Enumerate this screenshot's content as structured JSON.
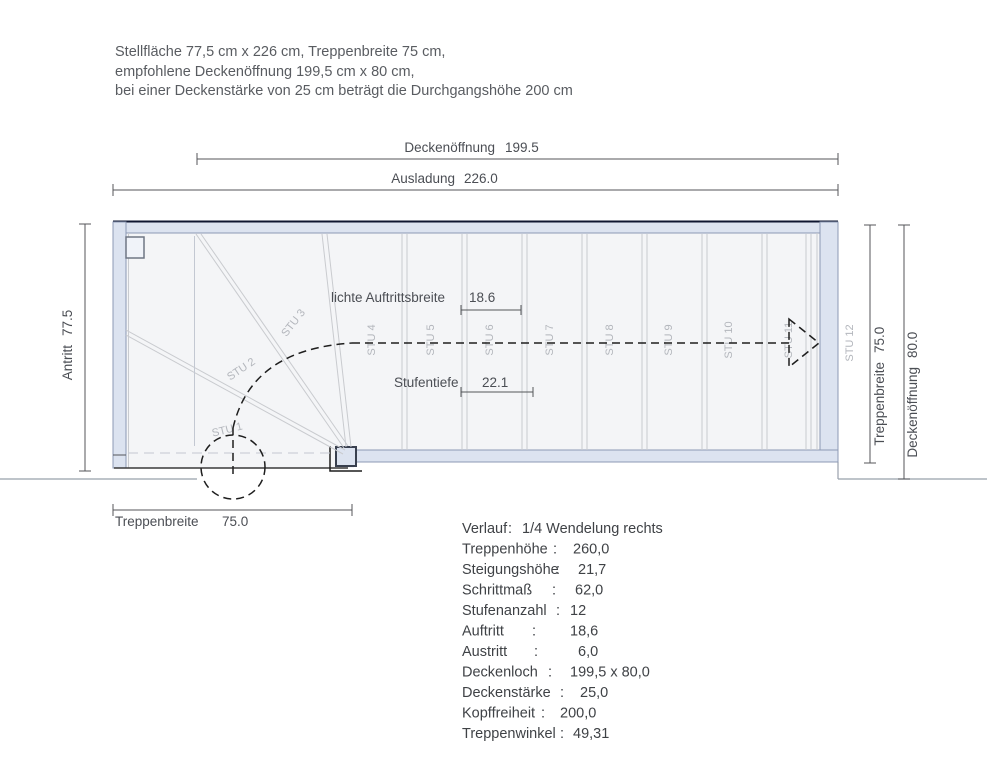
{
  "header": {
    "lines": [
      "Stellfläche 77,5 cm x 226 cm, Treppenbreite 75 cm,",
      "empfohlene Deckenöffnung 199,5 cm x 80 cm,",
      "bei einer Deckenstärke von 25 cm beträgt die Durchgangshöhe 200 cm"
    ]
  },
  "dims": {
    "deckenoeffnung_top": {
      "label": "Deckenöffnung",
      "value": "199.5"
    },
    "ausladung": {
      "label": "Ausladung",
      "value": "226.0"
    },
    "antritt": {
      "label": "Antritt",
      "value": "77.5"
    },
    "treppenbreite_right": {
      "label": "Treppenbreite",
      "value": "75.0"
    },
    "deckenoeffnung_right": {
      "label": "Deckenöffnung",
      "value": "80.0"
    },
    "treppenbreite_bottom": {
      "label": "Treppenbreite",
      "value": "75.0"
    },
    "auftrittsbreite": {
      "label": "lichte Auftrittsbreite",
      "value": "18.6"
    },
    "stufentiefe": {
      "label": "Stufentiefe",
      "value": "22.1"
    }
  },
  "steps": [
    "STU 1",
    "STU 2",
    "STU 3",
    "STU 4",
    "STU 5",
    "STU 6",
    "STU 7",
    "STU 8",
    "STU 9",
    "STU 10",
    "STU 11",
    "STU 12"
  ],
  "specs": {
    "colon": ":",
    "rows": [
      {
        "label": "Verlauf",
        "value": "1/4 Wendelung rechts"
      },
      {
        "label": "Treppenhöhe",
        "value": "260,0"
      },
      {
        "label": "Steigungshöhe",
        "value": "21,7"
      },
      {
        "label": "Schrittmaß",
        "value": "62,0"
      },
      {
        "label": "Stufenanzahl",
        "value": "12"
      },
      {
        "label": "Auftritt",
        "value": "18,6"
      },
      {
        "label": "Austritt",
        "value": "6,0"
      },
      {
        "label": "Deckenloch",
        "value": "199,5 x 80,0"
      },
      {
        "label": "Deckenstärke",
        "value": "25,0"
      },
      {
        "label": "Kopffreiheit",
        "value": "200,0"
      },
      {
        "label": "Treppenwinkel",
        "value": "49,31"
      }
    ]
  },
  "colors": {
    "header_text": "#595c61",
    "spec_text": "#3f4246",
    "dim_text": "#4b4e54",
    "dim_line": "#54565a",
    "step_label": "#b3b6bc",
    "step_line": "#c9cbcf",
    "hidden_line": "#c3c8d2",
    "wall_fill": "#dce3f0",
    "wall_stroke": "#8d99b4",
    "wall_top_edge": "#0e1630",
    "interior": "#f4f5f7",
    "walk_line": "#1e1e1e",
    "floor_line": "#98a0ab",
    "detail_fill": "#f0f3f9",
    "detail_stroke": "#6f7684",
    "post_stroke": "#39404f",
    "entry_line": "#3a3a3a"
  }
}
